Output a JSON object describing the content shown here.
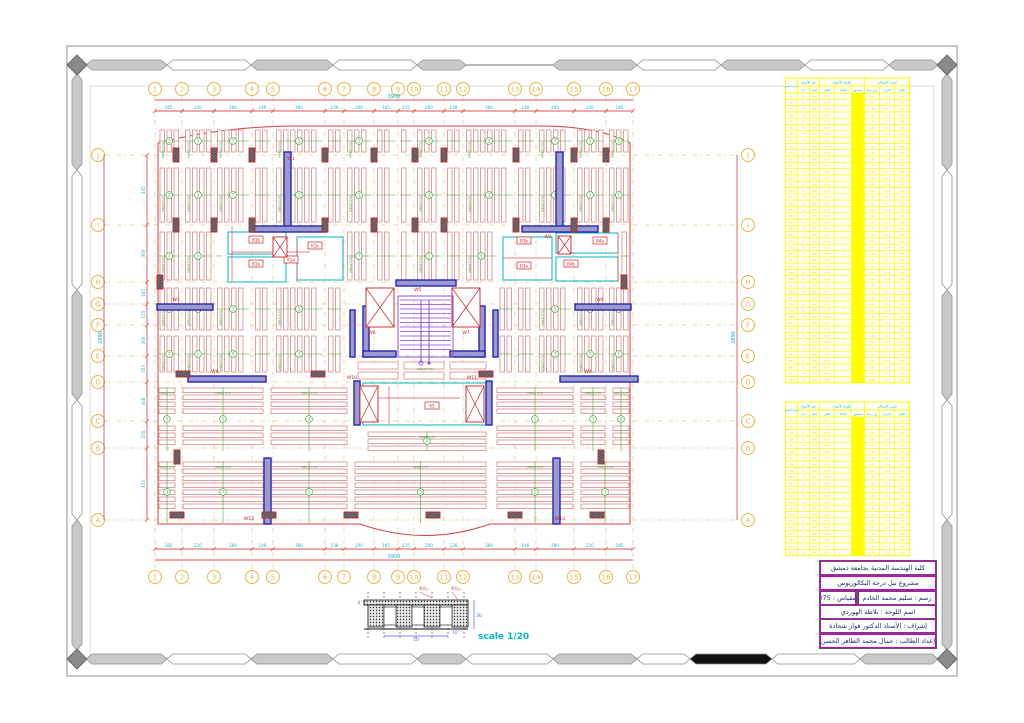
{
  "sheet": {
    "scale_label": "scale 1/20"
  },
  "colors": {
    "rib": "#d98a85",
    "dim_red": "#dd5555",
    "outline_red": "#cc4444",
    "cyan": "#00b7c3",
    "green": "#3fae3f",
    "wall_blue": "#2525b0",
    "wall_fill": "#9a9ace",
    "col_red": "#cc2222",
    "col_fill": "#6f6f7a",
    "bubble": "#e8b44a",
    "grid_dash": "#e7cf92",
    "purple": "#8a3fe0",
    "yellow": "#ffff00",
    "magenta": "#c400c4",
    "frame_gray": "#c9c9c9",
    "frame_edge": "#8f8f8f",
    "black": "#111111"
  },
  "frame": {
    "outer": [
      67,
      46,
      890,
      630
    ],
    "inner": [
      90,
      86,
      844,
      572
    ],
    "band_top_y": 65,
    "band_bottom_y": 659,
    "band_left_x": 77,
    "band_right_x": 947,
    "top_segments": [
      [
        86,
        167,
        "g"
      ],
      [
        167,
        251,
        "w"
      ],
      [
        251,
        333,
        "g"
      ],
      [
        333,
        417,
        "w"
      ],
      [
        417,
        466,
        "g"
      ],
      [
        466,
        553,
        "line"
      ],
      [
        553,
        637,
        "g"
      ],
      [
        637,
        721,
        "w"
      ],
      [
        721,
        805,
        "g"
      ],
      [
        805,
        889,
        "w"
      ],
      [
        889,
        938,
        "g"
      ]
    ],
    "bottom_segments": [
      [
        86,
        167,
        "g"
      ],
      [
        167,
        251,
        "w"
      ],
      [
        251,
        333,
        "g"
      ],
      [
        333,
        417,
        "w"
      ],
      [
        417,
        466,
        "g"
      ],
      [
        466,
        553,
        "w"
      ],
      [
        553,
        637,
        "g"
      ],
      [
        637,
        690,
        "w"
      ],
      [
        690,
        772,
        "k"
      ],
      [
        772,
        860,
        "w"
      ],
      [
        860,
        938,
        "g"
      ]
    ],
    "side_segments": [
      [
        74,
        170,
        "g"
      ],
      [
        170,
        290,
        "w"
      ],
      [
        290,
        400,
        "g"
      ],
      [
        400,
        520,
        "w"
      ],
      [
        520,
        650,
        "g"
      ]
    ]
  },
  "grid": {
    "col_labels": [
      "1",
      "2",
      "3",
      "4",
      "5",
      "6",
      "7",
      "8",
      "9",
      "10",
      "11",
      "12",
      "13",
      "14",
      "15",
      "16",
      "17"
    ],
    "col_x": [
      155,
      182,
      214,
      252,
      273,
      325,
      344,
      374,
      398,
      414,
      444,
      463,
      515,
      536,
      574,
      606,
      633
    ],
    "row_labels": [
      "J",
      "I",
      "H",
      "G",
      "F",
      "E",
      "D",
      "C",
      "B",
      "A"
    ],
    "row_y": [
      155,
      225,
      282,
      304,
      325,
      356,
      382,
      421,
      448,
      520
    ],
    "bubble_top_y": 89,
    "bubble_bottom_y": 577,
    "bubble_left_x": 98,
    "bubble_right_x": 748
  },
  "dims": {
    "top_segments": [
      "185",
      "220",
      "260",
      "140",
      "360",
      "130",
      "200",
      "165",
      "115",
      "200",
      "130",
      "360",
      "140",
      "260",
      "220",
      "185"
    ],
    "top_total": "3900",
    "bottom_total": "3900",
    "left_segments": [
      "445",
      "360",
      "165",
      "115",
      "300",
      "353",
      "308",
      "235",
      "415"
    ],
    "left_total": "2890",
    "right_total": "2890"
  },
  "plan": {
    "outline": "M158,143 Q220,127 292,126 L545,126 Q600,127 630,143 L630,524 L490,524 Q425,547 360,524 L158,524 Z",
    "green_callout": "8Φ8@T/70",
    "circle_nums": [
      "2",
      "3",
      "7",
      "1",
      "5"
    ],
    "v_bands": [
      {
        "y0": 130,
        "y1": 152,
        "x0": 158,
        "x1": 630,
        "skips": []
      },
      {
        "y0": 168,
        "y1": 222,
        "x0": 158,
        "x1": 630,
        "skips": []
      },
      {
        "y0": 232,
        "y1": 280,
        "x0": 158,
        "x1": 630,
        "skips": [
          [
            222,
            345
          ],
          [
            498,
            620
          ]
        ]
      },
      {
        "y0": 288,
        "y1": 330,
        "x0": 158,
        "x1": 630,
        "skips": [
          [
            348,
            498
          ]
        ]
      },
      {
        "y0": 336,
        "y1": 372,
        "x0": 158,
        "x1": 630,
        "skips": [
          [
            348,
            498
          ]
        ]
      }
    ],
    "h_groups": [
      {
        "x0": 159,
        "x1": 175,
        "y0": 386,
        "y1": 452,
        "breaks": [
          419,
          446
        ]
      },
      {
        "x0": 183,
        "x1": 263,
        "y0": 386,
        "y1": 452,
        "breaks": [
          419,
          446
        ]
      },
      {
        "x0": 271,
        "x1": 347,
        "y0": 386,
        "y1": 452,
        "breaks": [
          419,
          446
        ]
      },
      {
        "x0": 368,
        "x1": 486,
        "y0": 430,
        "y1": 452,
        "breaks": []
      },
      {
        "x0": 497,
        "x1": 573,
        "y0": 386,
        "y1": 452,
        "breaks": [
          419,
          446
        ]
      },
      {
        "x0": 581,
        "x1": 605,
        "y0": 386,
        "y1": 452,
        "breaks": [
          419,
          446
        ]
      },
      {
        "x0": 613,
        "x1": 629,
        "y0": 386,
        "y1": 452,
        "breaks": [
          419,
          446
        ]
      },
      {
        "x0": 159,
        "x1": 175,
        "y0": 460,
        "y1": 524,
        "breaks": [
          515
        ]
      },
      {
        "x0": 183,
        "x1": 263,
        "y0": 460,
        "y1": 524,
        "breaks": [
          515
        ]
      },
      {
        "x0": 271,
        "x1": 347,
        "y0": 460,
        "y1": 524,
        "breaks": [
          515
        ]
      },
      {
        "x0": 355,
        "x1": 486,
        "y0": 460,
        "y1": 524,
        "breaks": [
          515
        ]
      },
      {
        "x0": 497,
        "x1": 573,
        "y0": 460,
        "y1": 524,
        "breaks": [
          515
        ]
      },
      {
        "x0": 581,
        "x1": 629,
        "y0": 460,
        "y1": 524,
        "breaks": [
          515
        ]
      }
    ],
    "beam_strips": [
      [
        358,
        362,
        40,
        7
      ],
      [
        404,
        362,
        40,
        7
      ],
      [
        450,
        362,
        36,
        7
      ],
      [
        358,
        372,
        40,
        7
      ],
      [
        404,
        372,
        40,
        7
      ],
      [
        450,
        372,
        36,
        7
      ]
    ],
    "walls": [
      [
        284,
        152,
        7,
        76
      ],
      [
        250,
        226,
        76,
        6
      ],
      [
        556,
        152,
        7,
        76
      ],
      [
        522,
        226,
        76,
        6
      ],
      [
        157,
        304,
        56,
        6
      ],
      [
        575,
        304,
        56,
        6
      ],
      [
        396,
        280,
        60,
        6
      ],
      [
        363,
        306,
        6,
        51
      ],
      [
        363,
        351,
        33,
        6
      ],
      [
        479,
        306,
        6,
        51
      ],
      [
        450,
        351,
        35,
        6
      ],
      [
        350,
        310,
        5,
        47
      ],
      [
        493,
        310,
        5,
        47
      ],
      [
        188,
        376,
        78,
        6
      ],
      [
        560,
        376,
        78,
        6
      ],
      [
        354,
        381,
        6,
        44
      ],
      [
        486,
        381,
        6,
        44
      ],
      [
        264,
        458,
        7,
        66
      ],
      [
        553,
        458,
        7,
        66
      ]
    ],
    "wall_labels": [
      [
        "W1",
        291,
        160
      ],
      [
        "W2",
        548,
        238
      ],
      [
        "W3",
        176,
        301
      ],
      [
        "W4",
        600,
        301
      ],
      [
        "W5",
        418,
        291
      ],
      [
        "W6",
        372,
        334
      ],
      [
        "W7",
        466,
        334
      ],
      [
        "W8",
        215,
        373
      ],
      [
        "W9",
        588,
        373
      ],
      [
        "W10",
        352,
        379
      ],
      [
        "W11",
        472,
        379
      ],
      [
        "W12",
        249,
        520
      ],
      [
        "W13",
        560,
        520
      ]
    ],
    "columns_v": [
      [
        176,
        148
      ],
      [
        214,
        148
      ],
      [
        252,
        148
      ],
      [
        325,
        148
      ],
      [
        374,
        148
      ],
      [
        415,
        148
      ],
      [
        444,
        148
      ],
      [
        516,
        148
      ],
      [
        574,
        148
      ],
      [
        606,
        148
      ],
      [
        176,
        218
      ],
      [
        214,
        218
      ],
      [
        252,
        218
      ],
      [
        325,
        218
      ],
      [
        374,
        218
      ],
      [
        415,
        218
      ],
      [
        444,
        218
      ],
      [
        516,
        218
      ],
      [
        574,
        218
      ],
      [
        606,
        218
      ],
      [
        160,
        275
      ],
      [
        624,
        275
      ],
      [
        177,
        450
      ],
      [
        601,
        450
      ]
    ],
    "columns_h": [
      [
        176,
        374
      ],
      [
        311,
        374
      ],
      [
        479,
        374
      ],
      [
        170,
        515
      ],
      [
        262,
        515
      ],
      [
        344,
        515
      ],
      [
        426,
        515
      ],
      [
        508,
        515
      ],
      [
        590,
        515
      ]
    ],
    "xboxes": [
      [
        366,
        288,
        28,
        39
      ],
      [
        452,
        288,
        28,
        39
      ],
      [
        360,
        386,
        18,
        36
      ],
      [
        466,
        386,
        18,
        36
      ],
      [
        273,
        237,
        14,
        20
      ],
      [
        558,
        236,
        13,
        18
      ]
    ],
    "cyan_rects": [
      [
        228,
        232,
        58,
        22
      ],
      [
        228,
        257,
        58,
        25
      ],
      [
        297,
        237,
        46,
        43
      ],
      [
        503,
        237,
        49,
        43
      ],
      [
        556,
        233,
        62,
        20
      ],
      [
        556,
        257,
        62,
        24
      ],
      [
        363,
        383,
        125,
        42
      ]
    ],
    "boxed_labels": [
      [
        "B1b",
        256,
        240
      ],
      [
        "K1b",
        315,
        246
      ],
      [
        "B1a",
        256,
        264
      ],
      [
        "K1a",
        291,
        260
      ],
      [
        "B3b",
        524,
        241
      ],
      [
        "B4b",
        571,
        264
      ],
      [
        "B3a",
        524,
        266
      ],
      [
        "B4a",
        600,
        241
      ],
      [
        "K5",
        432,
        406
      ]
    ],
    "red_lines": [
      [
        232,
        252,
        310,
        252
      ],
      [
        297,
        237,
        297,
        282
      ],
      [
        503,
        258,
        552,
        258
      ],
      [
        368,
        398,
        460,
        398
      ],
      [
        389,
        386,
        389,
        424
      ],
      [
        232,
        226,
        232,
        282
      ],
      [
        618,
        233,
        618,
        282
      ]
    ],
    "stair": {
      "x": 398,
      "y": 296,
      "w": 55,
      "h": 61
    }
  },
  "tables": {
    "x": 785.5,
    "w": 124,
    "col_w": [
      12,
      12,
      10,
      15,
      17,
      13,
      15,
      15,
      15
    ],
    "solid_col": 5,
    "header": {
      "h1": 8,
      "h2": 7,
      "corner": "اسم العنصر",
      "groups": [
        {
          "label": "عدد الأسياخ",
          "c0": 1,
          "c1": 2
        },
        {
          "label": "أطوال الأسياخ",
          "c0": 3,
          "c1": 5
        },
        {
          "label": "الوزن الإجمالي",
          "c0": 6,
          "c1": 8
        }
      ],
      "subs": [
        "",
        "عدد",
        "قطر",
        "الطول",
        "الشكل",
        "المجموع",
        "وزن م.ط",
        "الجزئي",
        "الكلي"
      ]
    },
    "t1": {
      "y": 78,
      "rows": 46,
      "row_h": 6.3,
      "prefix": "B"
    },
    "t2": {
      "y": 402,
      "rows": 22,
      "row_h": 6.3,
      "prefix": "N"
    },
    "row_values": [
      "~",
      "8",
      "Φ8",
      "4.25",
      "ـــ",
      "",
      "0.40",
      "13.4",
      "168"
    ]
  },
  "title_block": {
    "x": 820,
    "w": 114,
    "row_h": 12,
    "rows_y": [
      561,
      576,
      591,
      605,
      619,
      634
    ],
    "r1": "كلية الهندسة المدنية بجامعة دمشق",
    "r2": "مشروع نيل درجة البكالوريوس",
    "r3_right": "رسم : سليم محمد الخادم",
    "r3_left": "المقياس : 1/75",
    "r4": "اسم اللوحة : بلاطة الهوردي",
    "r5": "إشراف : الأستاذ الدكتور فواز شحادة",
    "r6": "إعداد الطالب : جمال محمد الطاهر الحسن"
  },
  "detail": {
    "scale_label": "scale 1/20",
    "dashed_x": [
      368,
      384,
      400,
      416,
      432,
      448,
      464
    ],
    "hatched_blocks": [
      368,
      396,
      424,
      452
    ],
    "white_blocks": [
      384,
      412,
      440
    ],
    "dim_right": "30",
    "dim_bottom": "50",
    "dim_small": "10",
    "dim_left": "6",
    "callout1": "Φ8/م",
    "callout2": "Φ6/م"
  }
}
